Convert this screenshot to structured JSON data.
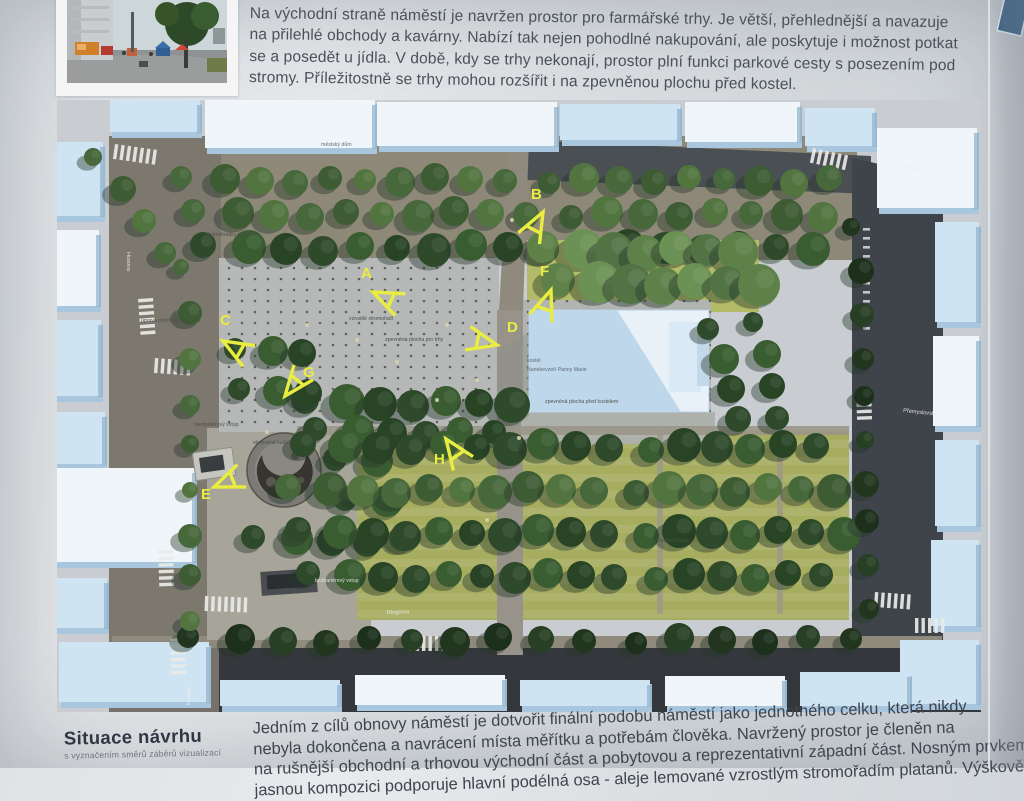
{
  "poster": {
    "top_paragraph_lines": [
      "Na východní straně náměstí je navržen prostor pro farmářské trhy. Je větší, přehlednější a navazuje",
      "na přilehlé obchody a kavárny. Nabízí tak nejen pohodlné nakupování, ale poskytuje i možnost potkat",
      "se a posedět u jídla. V době, kdy se trhy nekonají, prostor plní funkci parkové cesty s posezením pod",
      "stromy. Příležitostně se trhy mohou rozšířit i na zpevněnou plochu před kostel."
    ],
    "bottom_paragraph_lines": [
      "Jedním z cílů obnovy náměstí je dotvořit finální podobu náměstí jako jednotného celku, která nikdy",
      "nebyla dokončena a navrácení místa měřítku a potřebám člověka. Navržený prostor je členěn na",
      "na rušnější obchodní a trhovou východní část a pobytovou a reprezentativní západní část. Nosným prvkem",
      "jasnou kompozici podporuje hlavní podélná osa - aleje lemované vzrostlým stromořadím platanů. Výškově"
    ],
    "figure_title": "Situace návrhu",
    "figure_subtitle": "s vyznačením směrů záběrů vizualizací"
  },
  "map": {
    "markers": [
      {
        "letter": "A",
        "lx": 304,
        "ly": 178,
        "cx": 316,
        "cy": 192,
        "rot": 25
      },
      {
        "letter": "B",
        "lx": 474,
        "ly": 99,
        "cx": 486,
        "cy": 112,
        "rot": 118
      },
      {
        "letter": "C",
        "lx": 163,
        "ly": 225,
        "cx": 166,
        "cy": 241,
        "rot": 30
      },
      {
        "letter": "D",
        "lx": 450,
        "ly": 232,
        "cx": 440,
        "cy": 245,
        "rot": 193
      },
      {
        "letter": "E",
        "lx": 144,
        "ly": 399,
        "cx": 157,
        "cy": 387,
        "rot": -22
      },
      {
        "letter": "F",
        "lx": 483,
        "ly": 176,
        "cx": 494,
        "cy": 190,
        "rot": 110
      },
      {
        "letter": "G",
        "lx": 246,
        "ly": 277,
        "cx": 228,
        "cy": 296,
        "rot": -52
      },
      {
        "letter": "H",
        "lx": 377,
        "ly": 364,
        "cx": 389,
        "cy": 339,
        "rot": 55
      }
    ],
    "street_labels": [
      {
        "text": "Husova",
        "x": 70,
        "y": 152,
        "rot": 90
      },
      {
        "text": "Jodlova",
        "x": 130,
        "y": 586,
        "rot": 90
      },
      {
        "text": "Riegrova",
        "x": 330,
        "y": 514,
        "rot": -2
      },
      {
        "text": "Přemyslovská",
        "x": 846,
        "y": 312,
        "rot": 6
      },
      {
        "text": "Lutovítova",
        "x": 840,
        "y": 66,
        "rot": 12
      }
    ],
    "area_labels": [
      {
        "text": "městský dům",
        "x": 264,
        "y": 46,
        "c": "#5a6671"
      },
      {
        "text": "předzahrádky kaváren",
        "x": 148,
        "y": 136,
        "c": "#4a4f45"
      },
      {
        "text": "úprava přechodu pro pěší",
        "x": 84,
        "y": 222,
        "c": "#4a4f45"
      },
      {
        "text": "vzrostlé stromořadí",
        "x": 292,
        "y": 220,
        "c": "#43493f"
      },
      {
        "text": "zpevněná plocha pro trhy",
        "x": 328,
        "y": 241,
        "c": "#43493f"
      },
      {
        "text": "kostel",
        "x": 470,
        "y": 262,
        "c": "#5a6671"
      },
      {
        "text": "Nanebevzetí Panny Marie",
        "x": 470,
        "y": 271,
        "c": "#5a6671"
      },
      {
        "text": "zpevněná plocha před kostelem",
        "x": 488,
        "y": 303,
        "c": "#4a4f45"
      },
      {
        "text": "bezbariérový vstup",
        "x": 138,
        "y": 326,
        "c": "#4a4f45"
      },
      {
        "text": "obnovená kašna",
        "x": 196,
        "y": 344,
        "c": "#4a4f45"
      },
      {
        "text": "bezbariérový vstup",
        "x": 258,
        "y": 482,
        "c": "#e3e4e0"
      },
      {
        "text": "pobytová louka",
        "x": 598,
        "y": 442,
        "c": "#4a4f45"
      }
    ],
    "colors": {
      "marker_yellow": "#e9ed3f",
      "lawn": "#a6ad5f",
      "plaza": "#b6b8b7",
      "road_dark": "#3f444a",
      "ground_light": "#8d8878",
      "building": "#cfe4f3",
      "building_roof": "#f0f5f9",
      "tree_dark": "#2e4a2a",
      "church": "#e8f1f8"
    }
  }
}
